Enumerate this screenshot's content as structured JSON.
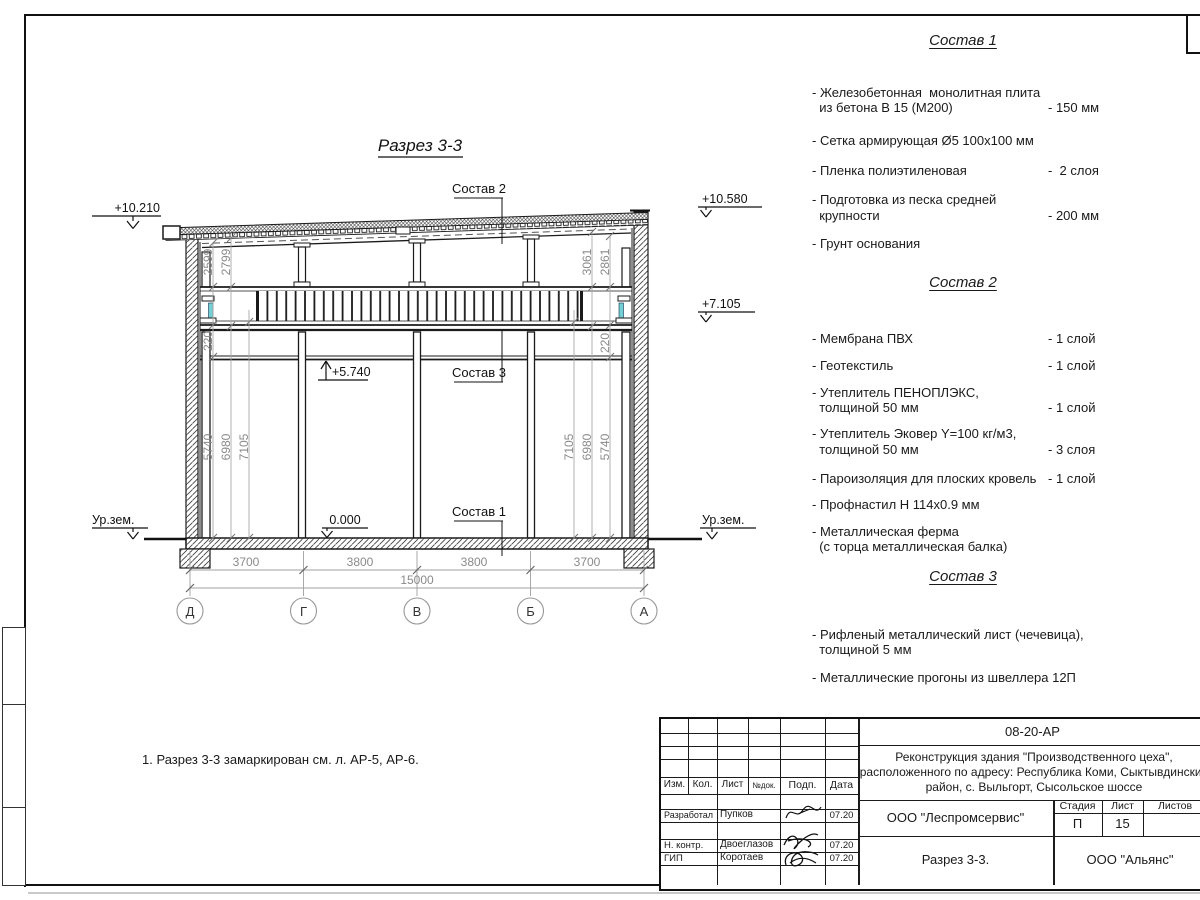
{
  "drawing": {
    "title": "Разрез 3-3",
    "labels": {
      "sostav1": "Состав 1",
      "sostav2": "Состав 2",
      "sostav3": "Состав 3"
    },
    "elevations": {
      "left_top": "+10.210",
      "right_top": "+10.580",
      "right_mid": "+7.105",
      "mezzanine": "+5.740",
      "floor": "0.000",
      "ground_left": "Ур.зем.",
      "ground_right": "Ур.зем."
    },
    "vdims_left": [
      "2599",
      "2799",
      "220",
      "5740",
      "6980",
      "7105"
    ],
    "vdims_right": [
      "3061",
      "2861",
      "220",
      "7105",
      "6980",
      "5740"
    ],
    "bottom_dims": [
      "3700",
      "3800",
      "3800",
      "3700"
    ],
    "total_dim": "15000",
    "axes": [
      "Д",
      "Г",
      "В",
      "Б",
      "А"
    ],
    "note": "1. Разрез 3-3 замаркирован см. л. АР-5, АР-6."
  },
  "compositions": [
    {
      "title": "Состав 1",
      "items": [
        {
          "name": "- Железобетонная  монолитная плита\n  из бетона В 15 (М200)",
          "value": "- 150 мм"
        },
        {
          "name": "- Сетка армирующая Ø5 100х100 мм",
          "value": ""
        },
        {
          "name": "- Пленка полиэтиленовая",
          "value": "-  2 слоя"
        },
        {
          "name": "- Подготовка из песка средней\n  крупности",
          "value": "- 200 мм"
        },
        {
          "name": "- Грунт основания",
          "value": ""
        }
      ]
    },
    {
      "title": "Состав 2",
      "items": [
        {
          "name": "- Мембрана ПВХ",
          "value": "- 1 слой"
        },
        {
          "name": "- Геотекстиль",
          "value": "- 1 слой"
        },
        {
          "name": "- Утеплитель ПЕНОПЛЭКС,\n  толщиной 50 мм",
          "value": "- 1 слой"
        },
        {
          "name": "- Утеплитель Эковер Y=100 кг/м3,\n  толщиной 50 мм",
          "value": "- 3 слоя"
        },
        {
          "name": "- Пароизоляция для плоских кровель",
          "value": "- 1 слой"
        },
        {
          "name": "- Профнастил Н 114х0.9 мм",
          "value": ""
        },
        {
          "name": "- Металлическая ферма\n  (с торца металлическая балка)",
          "value": ""
        }
      ]
    },
    {
      "title": "Состав 3",
      "items": [
        {
          "name": "- Рифленый металлический лист (чечевица),\n  толщиной 5 мм",
          "value": ""
        },
        {
          "name": "- Металлические прогоны из швеллера 12П",
          "value": ""
        }
      ]
    }
  ],
  "titleblock": {
    "doc_number": "08-20-АР",
    "project": "Реконструкция здания \"Производственного цеха\",\nрасположенного по адресу: Республика Коми, Сыктывдинский\nрайон, с. Выльгорт, Сысольское шоссе",
    "cols": {
      "izm": "Изм.",
      "kol": "Кол.",
      "list": "Лист",
      "ndok": "№док.",
      "podp": "Подп.",
      "data": "Дата"
    },
    "rows": [
      {
        "role": "Разработал",
        "name": "Пупков",
        "date": "07.20"
      },
      {
        "role": "Н. контр.",
        "name": "Двоеглазов",
        "date": "07.20"
      },
      {
        "role": "ГИП",
        "name": "Коротаев",
        "date": "07.20"
      }
    ],
    "org": "ООО \"Леспромсервис\"",
    "stage_label": "Стадия",
    "sheet_label": "Лист",
    "sheets_label": "Листов",
    "stage": "П",
    "sheet_num": "15",
    "sheets_num": "",
    "drawing_name": "Разрез 3-3.",
    "customer": "ООО \"Альянс\""
  },
  "colors": {
    "line": "#1a1a1a",
    "dim": "#8f8f8f",
    "accent_cyan": "#74cfd2"
  }
}
